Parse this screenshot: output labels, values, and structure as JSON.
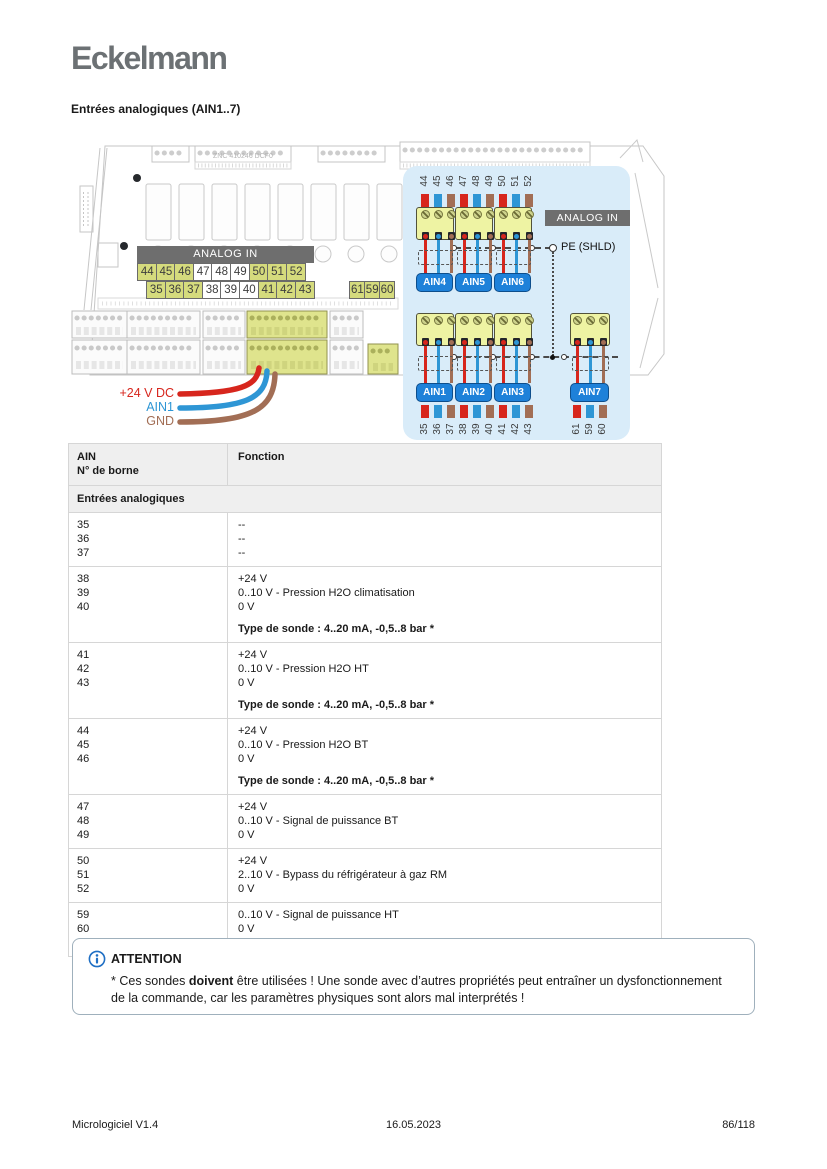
{
  "colors": {
    "red": "#d7261d",
    "blue": "#2e96d5",
    "brown": "#a26e55",
    "yellow_highlight": "#d5db7d",
    "panel_blue": "#d9ecf9",
    "banner_gray": "#6e6e6e",
    "ain_blue": "#1e81d9"
  },
  "page": {
    "logo": "Eckelmann",
    "heading": "Entrées analogiques (AIN1..7)",
    "footer": {
      "left": "Micrologiciel V1.4",
      "center": "16.05.2023",
      "right": "86/118"
    }
  },
  "diagram": {
    "board_label": "ZNC 410246 DCF0",
    "banner_label": "ANALOG IN",
    "strips": {
      "row1": [
        {
          "n": "44",
          "hl": true
        },
        {
          "n": "45",
          "hl": true
        },
        {
          "n": "46",
          "hl": true
        },
        {
          "n": "47",
          "hl": false
        },
        {
          "n": "48",
          "hl": false
        },
        {
          "n": "49",
          "hl": false
        },
        {
          "n": "50",
          "hl": true
        },
        {
          "n": "51",
          "hl": true
        },
        {
          "n": "52",
          "hl": true
        }
      ],
      "row2": [
        {
          "n": "35",
          "hl": true
        },
        {
          "n": "36",
          "hl": true
        },
        {
          "n": "37",
          "hl": true
        },
        {
          "n": "38",
          "hl": false
        },
        {
          "n": "39",
          "hl": false
        },
        {
          "n": "40",
          "hl": false
        },
        {
          "n": "41",
          "hl": true
        },
        {
          "n": "42",
          "hl": true
        },
        {
          "n": "43",
          "hl": true
        }
      ],
      "row3": [
        {
          "n": "61",
          "hl": true
        },
        {
          "n": "59",
          "hl": true
        },
        {
          "n": "60",
          "hl": true
        }
      ]
    },
    "wire_labels": [
      {
        "label": "+24 V DC",
        "color": "red"
      },
      {
        "label": "AIN1",
        "color": "blue"
      },
      {
        "label": "GND",
        "color": "brown"
      }
    ],
    "panel": {
      "banner": "ANALOG IN",
      "pe_label": "PE (SHLD)",
      "top_numbers": [
        "44",
        "45",
        "46",
        "47",
        "48",
        "49",
        "50",
        "51",
        "52"
      ],
      "top_labels": [
        "AIN4",
        "AIN5",
        "AIN6"
      ],
      "bottom_numbers": [
        "35",
        "36",
        "37",
        "38",
        "39",
        "40",
        "41",
        "42",
        "43"
      ],
      "bottom_labels": [
        "AIN1",
        "AIN2",
        "AIN3"
      ],
      "ain7": {
        "label": "AIN7",
        "numbers": [
          "61",
          "59",
          "60"
        ]
      }
    }
  },
  "table": {
    "header": {
      "col1_line1": "AIN",
      "col1_line2": "N° de borne",
      "col2": "Fonction"
    },
    "section": "Entrées analogiques",
    "rows": [
      {
        "terminals": [
          "35",
          "36",
          "37"
        ],
        "lines": [
          "--",
          "--",
          "--"
        ]
      },
      {
        "terminals": [
          "38",
          "39",
          "40"
        ],
        "lines": [
          "+24 V",
          "0..10 V - Pression H2O climatisation",
          "0 V"
        ],
        "note": "Type de sonde : 4..20 mA, -0,5..8 bar *"
      },
      {
        "terminals": [
          "41",
          "42",
          "43"
        ],
        "lines": [
          "+24 V",
          "0..10 V - Pression H2O HT",
          "0 V"
        ],
        "note": "Type de sonde : 4..20 mA, -0,5..8 bar *"
      },
      {
        "terminals": [
          "44",
          "45",
          "46"
        ],
        "lines": [
          "+24 V",
          "0..10 V - Pression H2O BT",
          "0 V"
        ],
        "note": "Type de sonde : 4..20 mA, -0,5..8 bar *"
      },
      {
        "terminals": [
          "47",
          "48",
          "49"
        ],
        "lines": [
          "+24 V",
          "0..10 V - Signal de puissance BT",
          "0 V"
        ]
      },
      {
        "terminals": [
          "50",
          "51",
          "52"
        ],
        "lines": [
          "+24 V",
          "2..10 V - Bypass du réfrigérateur à gaz RM",
          "0 V"
        ]
      },
      {
        "terminals": [
          "59",
          "60",
          "61"
        ],
        "lines": [
          "0..10 V - Signal de puissance HT",
          "0 V",
          "+24 V"
        ]
      }
    ]
  },
  "attention": {
    "title": "ATTENTION",
    "body_prefix": " * Ces sondes ",
    "body_bold": "doivent",
    "body_suffix": " être utilisées ! Une sonde avec d’autres propriétés peut entraîner un dysfonctionnement de la commande, car les paramètres physiques sont alors mal interprétés !"
  }
}
